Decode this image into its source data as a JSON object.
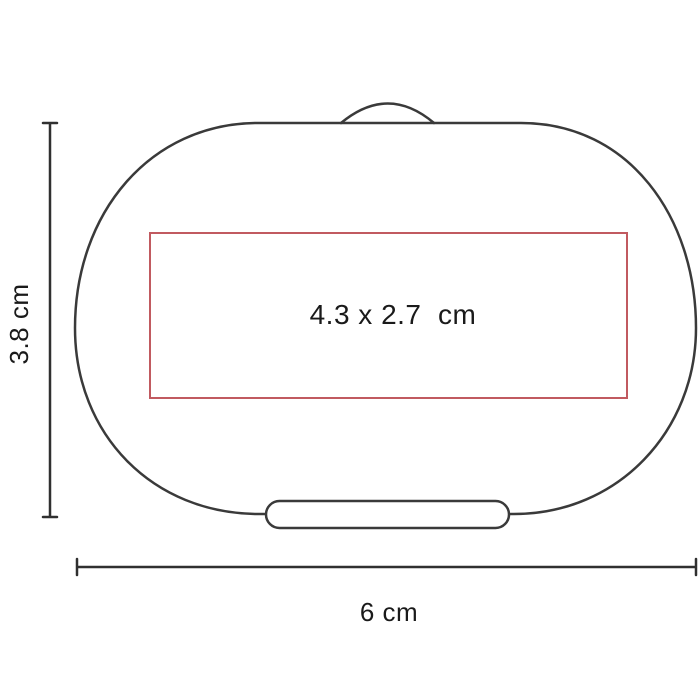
{
  "diagram": {
    "background_color": "#ffffff",
    "outline_color": "#3a3a3a",
    "dimension_line_color": "#303030",
    "text_color": "#1a1a1a",
    "print_area": {
      "label": "4.3 x 2.7  cm",
      "border_color": "#c15a60"
    },
    "dimensions": {
      "height_label": "3.8 cm",
      "width_label": "6 cm"
    }
  }
}
